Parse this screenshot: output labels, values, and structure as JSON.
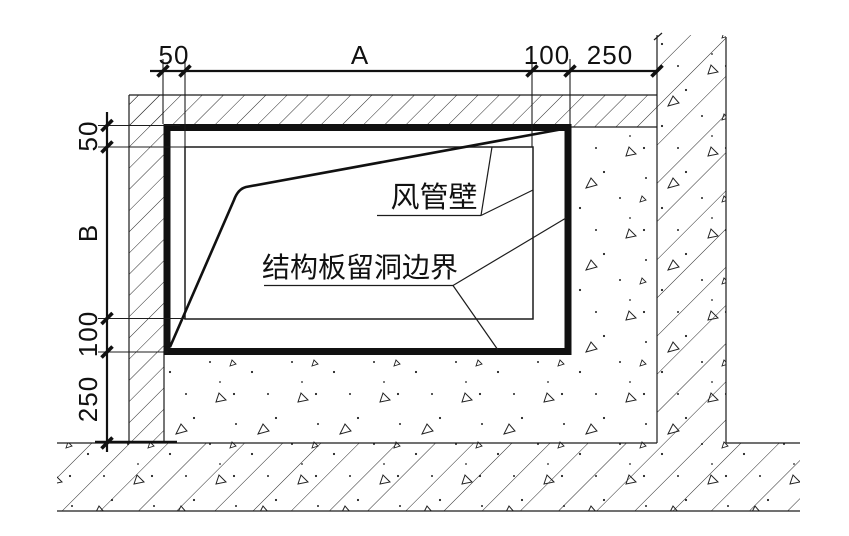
{
  "drawing": {
    "kind": "construction-detail-section",
    "description_visible_text_only": true
  },
  "annotations": {
    "duct_wall": "风管壁",
    "opening_boundary": "结构板留洞边界"
  },
  "dimensions": {
    "top": {
      "items": [
        {
          "name": "opening-offset-left",
          "label": "50"
        },
        {
          "name": "duct-width",
          "label": "A"
        },
        {
          "name": "opening-offset-right",
          "label": "100"
        },
        {
          "name": "distance-to-wall",
          "label": "250"
        }
      ]
    },
    "left": {
      "items": [
        {
          "name": "opening-offset-top",
          "label": "50"
        },
        {
          "name": "duct-height",
          "label": "B"
        },
        {
          "name": "opening-offset-bottom",
          "label": "100"
        },
        {
          "name": "distance-to-floor",
          "label": "250"
        }
      ]
    }
  },
  "colors": {
    "line": "#1c1c1c",
    "background": "#ffffff"
  }
}
